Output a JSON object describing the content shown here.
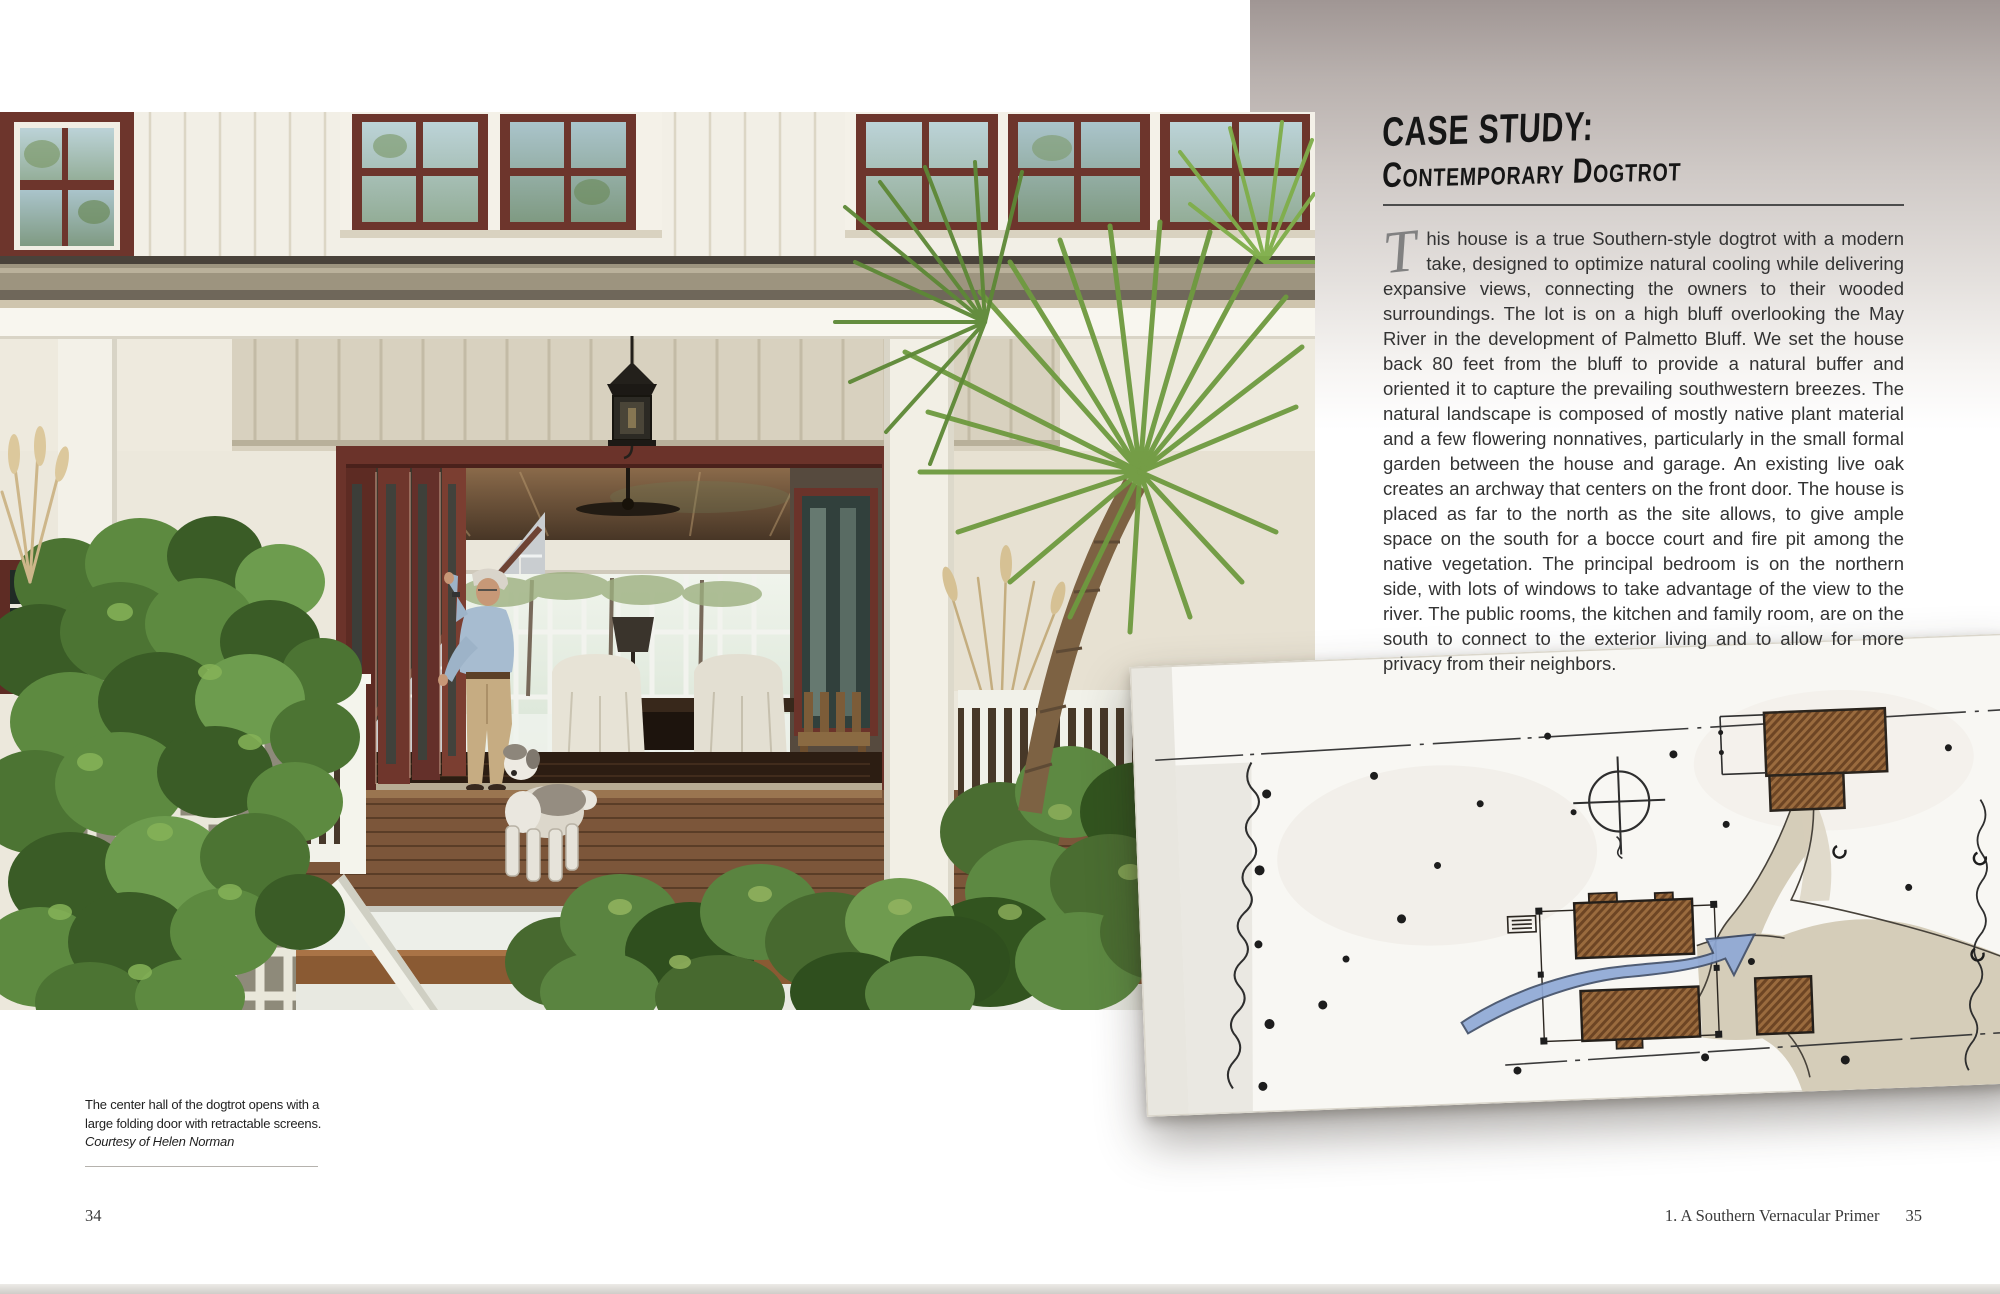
{
  "left_page": {
    "photo_subject": "Southern dogtrot house porch with open folding doors, a man, a sheepdog, deck steps, trellis vines and palmetto fronds",
    "caption": {
      "text": "The center hall of the dogtrot opens with a large folding door with retractable screens.",
      "credit": "Courtesy of Helen Norman"
    },
    "page_number": "34"
  },
  "right_page": {
    "heading": {
      "line1": "CASE STUDY:",
      "line2": "Contemporary Dogtrot"
    },
    "article": {
      "drop_cap": "T",
      "body": "his house is a true Southern-style dogtrot with a modern take, designed to optimize natural cooling while delivering expansive views, connecting the owners to their wooded surroundings. The lot is on a high bluff overlooking the May River in the development of Palmetto Bluff. We set the house back 80 feet from the bluff to provide a natural buffer and oriented it to capture the prevailing southwestern breezes. The natural landscape is composed of mostly native plant material and a few flowering nonnatives, particularly in the small formal garden between the house and garage. An existing live oak creates an archway that centers on the front door. The house is placed as far to the north as the site allows, to give ample space on the south for a bocce court and fire pit among the native vegetation. The principal bedroom is on the northern side, with lots of windows to take advantage of the view to the river. The public rooms, the kitchen and family room, are on the south to connect to the exterior living and to allow for more privacy from their neighbors."
    },
    "sketch_subject": "Hand-drawn watercolor site plan: river bluff edge, compass, garage, dogtrot house with breeze arrow, drive and native trees",
    "footer": {
      "chapter": "1. A Southern Vernacular Primer",
      "page_number": "35"
    }
  },
  "colors": {
    "gradient_top": "#a09694",
    "window_maroon": "#6b332a",
    "foliage_green": "#55812e",
    "deck_brown": "#7c563a",
    "sketch_hatch_brown": "#9a6b3e",
    "sketch_arrow_blue": "#8fa9d6"
  }
}
